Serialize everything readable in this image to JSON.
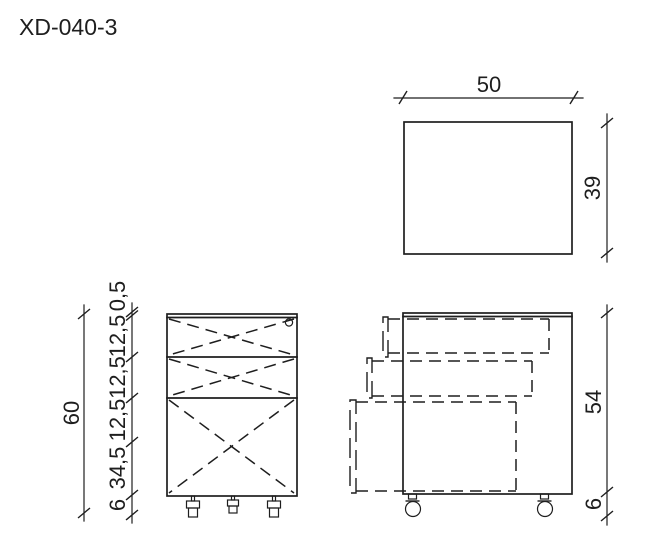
{
  "title": "XD-040-3",
  "colors": {
    "line": "#1e1e1e",
    "background": "#ffffff"
  },
  "top_view": {
    "width_label": "50",
    "depth_label": "39"
  },
  "front_view": {
    "overall_height_label": "60",
    "chain_labels": [
      "0,5",
      "12,5",
      "12,5",
      "12,5",
      "34,5",
      "6"
    ]
  },
  "side_view": {
    "body_height_label": "54",
    "caster_height_label": "6"
  }
}
